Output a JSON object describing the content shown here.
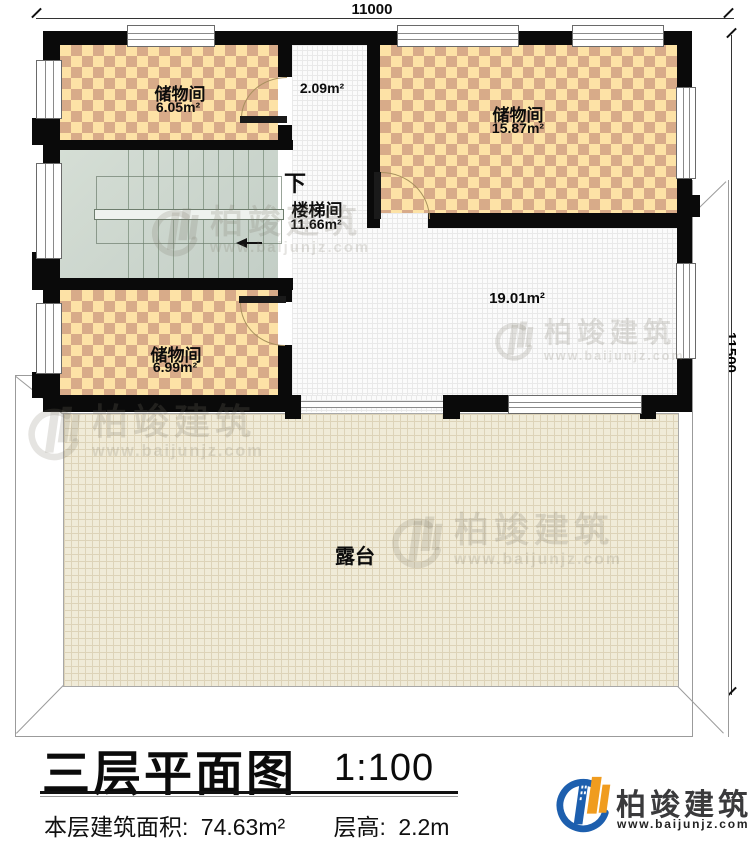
{
  "plan_title": {
    "title": "三层平面图",
    "scale": "1:100"
  },
  "info": {
    "area_label": "本层建筑面积:",
    "area_value": "74.63m²",
    "height_label": "层高:",
    "height_value": "2.2m"
  },
  "dimensions": {
    "top": "11000",
    "right": "11500"
  },
  "rooms": {
    "storage_top_left": {
      "name": "储物间",
      "area": "6.05m²"
    },
    "hallway": {
      "area": "2.09m²"
    },
    "storage_top_right": {
      "name": "储物间",
      "area": "15.87m²"
    },
    "stairwell": {
      "name": "楼梯间",
      "area": "11.66m²",
      "direction": "下"
    },
    "storage_bottom_left": {
      "name": "储物间",
      "area": "6.99m²"
    },
    "open_area": {
      "area": "19.01m²"
    },
    "terrace": {
      "name": "露台"
    }
  },
  "brand": {
    "name": "柏竣建筑",
    "url": "www.baijunjz.com"
  },
  "colors": {
    "wall": "#0a0a0a",
    "checker_base": "#fde2a6",
    "checker_tile": "#d8ab89",
    "stair": "#ccd5cc",
    "terrace": "#f0ebd8",
    "logo_blue": "#1d5fae",
    "logo_orange": "#f09c1f"
  }
}
